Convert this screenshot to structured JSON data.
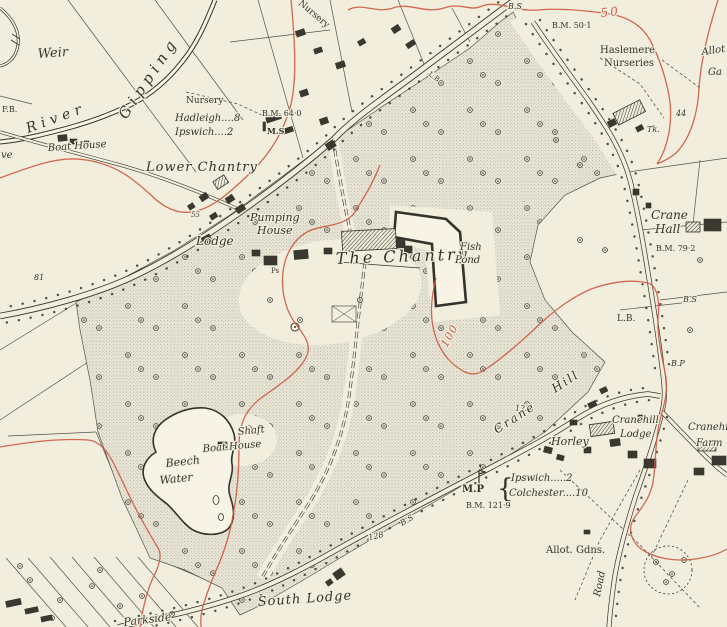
{
  "map": {
    "colors": {
      "paper": "#f2eedd",
      "ink": "#35332c",
      "contour_red": "#cf5c45",
      "parkland_tint": "#dedbcb",
      "water": "#f7f4e6"
    },
    "labels": {
      "weir": "Weir",
      "river": "River",
      "gipping": "Gipping",
      "fb": "F.B.",
      "boat_house_river": "Boat House",
      "grove_partial": "ve",
      "nursery_plot": "Nursery",
      "hadleigh_ms": "Hadleigh....8",
      "ipswich_ms": "Ipswich....2",
      "bm_64_0": "B.M. 64·0",
      "ms": "M.S",
      "nursery_diag": "Nursery",
      "bs_top": "B.S",
      "bm_50_1": "B.M. 50·1",
      "contour_50": "50",
      "haslemere_1": "Haslemere",
      "haslemere_2": "Nurseries",
      "allot_edge": "Allot",
      "gardens_edge": "Ga",
      "num_44": "44",
      "tk": "Tk.",
      "lower_chantry": "Lower Chantry",
      "num_55": "55",
      "lodge": "Lodge",
      "pumping_1": "Pumping",
      "pumping_2": "House",
      "ps": "Ps",
      "the_chantry": "The Chantry",
      "fish_1": "Fish",
      "fish_2": "Pond",
      "lb_road": "L.B",
      "crane_hall_1": "Crane",
      "crane_hall_2": "Hall",
      "bm_79_2": "B.M. 79·2",
      "num_81": "81",
      "bs_east": "B.S",
      "lb_east": "L.B.",
      "bp_east": "B.P",
      "contour_100": "100",
      "num_123": "123",
      "crane_hill_1": "Crane",
      "crane_hill_2": "Hill",
      "horley": "Horley",
      "shaft": "Shaft",
      "boat_house_pond": "Boat House",
      "beech_1": "Beech",
      "beech_2": "Water",
      "mp": "M.P",
      "mp_brace": "{",
      "mp_ipswich": "Ipswich.....2",
      "mp_colchester": "Colchester....10",
      "bm_121_9": "B.M. 121·9",
      "bs_southwest": "B.S",
      "num_128": "128",
      "allot_gdns": "Allot. Gdns.",
      "road_vertical": "Road",
      "cranehill_lodge_1": "Cranehill",
      "cranehill_lodge_2": "Lodge",
      "cranehill_farm_1": "Cranehill",
      "cranehill_farm_2": "Farm",
      "south_lodge": "South Lodge",
      "parkside": "Parkside"
    }
  }
}
